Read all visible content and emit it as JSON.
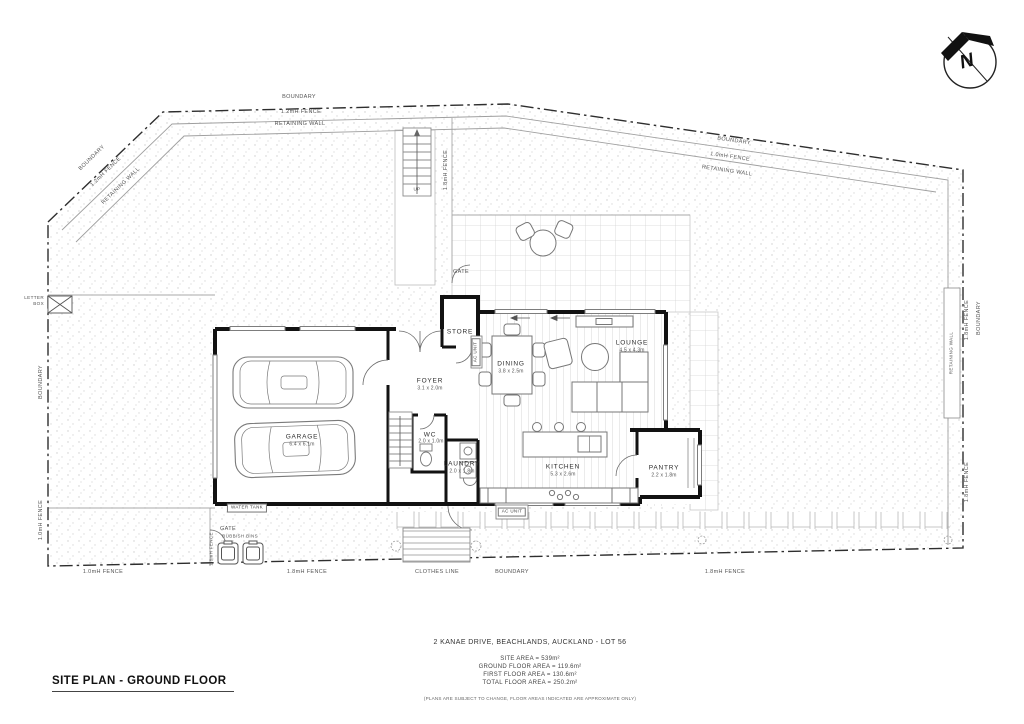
{
  "title_block": {
    "title": "SITE PLAN - GROUND FLOOR"
  },
  "summary": {
    "address": "2 KANAE DRIVE, BEACHLANDS, AUCKLAND - LOT 56",
    "site_area": "SITE AREA = 539m²",
    "ground_floor_area": "GROUND FLOOR AREA = 119.6m²",
    "first_floor_area": "FIRST FLOOR AREA = 130.6m²",
    "total_floor_area": "TOTAL FLOOR AREA = 250.2m²",
    "note": "(PLANS ARE SUBJECT TO CHANGE, FLOOR AREAS INDICATED ARE APPROXIMATE ONLY)"
  },
  "north_arrow": {
    "label": "N"
  },
  "rooms": {
    "garage": {
      "name": "GARAGE",
      "dim": "6.4 x 6.1m"
    },
    "foyer": {
      "name": "FOYER",
      "dim": "3.1 x 2.0m"
    },
    "store": {
      "name": "STORE"
    },
    "wc": {
      "name": "WC",
      "dim": "2.0 x 1.0m"
    },
    "laundry": {
      "name": "LAUNDRY",
      "dim": "2.0 x 1.8m"
    },
    "dining": {
      "name": "DINING",
      "dim": "3.8 x 2.5m"
    },
    "lounge": {
      "name": "LOUNGE",
      "dim": "4.5 x 4.3m"
    },
    "kitchen": {
      "name": "KITCHEN",
      "dim": "5.3 x 2.6m"
    },
    "pantry": {
      "name": "PANTRY",
      "dim": "2.2 x 1.8m"
    }
  },
  "site": {
    "boundary_top": "BOUNDARY",
    "fence_top": "1.2mH FENCE",
    "retaining_top": "RETAINING WALL",
    "boundary_tl": "BOUNDARY",
    "fence_tl": "1.2mH FENCE",
    "retaining_tl": "RETAINING WALL",
    "boundary_tr": "BOUNDARY",
    "fence_tr": "1.0mH FENCE",
    "retaining_tr": "RETAINING WALL",
    "retaining_right": "RETAINING WALL",
    "fence_right_upper": "1.8mH FENCE",
    "boundary_right": "BOUNDARY",
    "fence_right_lower": "1.8mH FENCE",
    "boundary_left": "BOUNDARY",
    "fence_left": "1.0mH FENCE",
    "letter_box": "LETTER BOX",
    "fence_bottom_left": "1.0mH FENCE",
    "fence_bottom_mid": "1.8mH FENCE",
    "clothes_line": "CLOTHES LINE",
    "boundary_bottom": "BOUNDARY",
    "fence_bottom_right": "1.8mH FENCE",
    "gate_top": "GATE",
    "gate_bottom": "GATE",
    "rubbish_bins": "RUBBISH BINS",
    "fence_bins": "1.8mH FENCE",
    "water_tank": "WATER TANK",
    "up": "UP",
    "fence_stairs": "1.8mH FENCE",
    "ac_unit_wall": "AC UNIT",
    "ac_unit_ground": "AC UNIT"
  }
}
